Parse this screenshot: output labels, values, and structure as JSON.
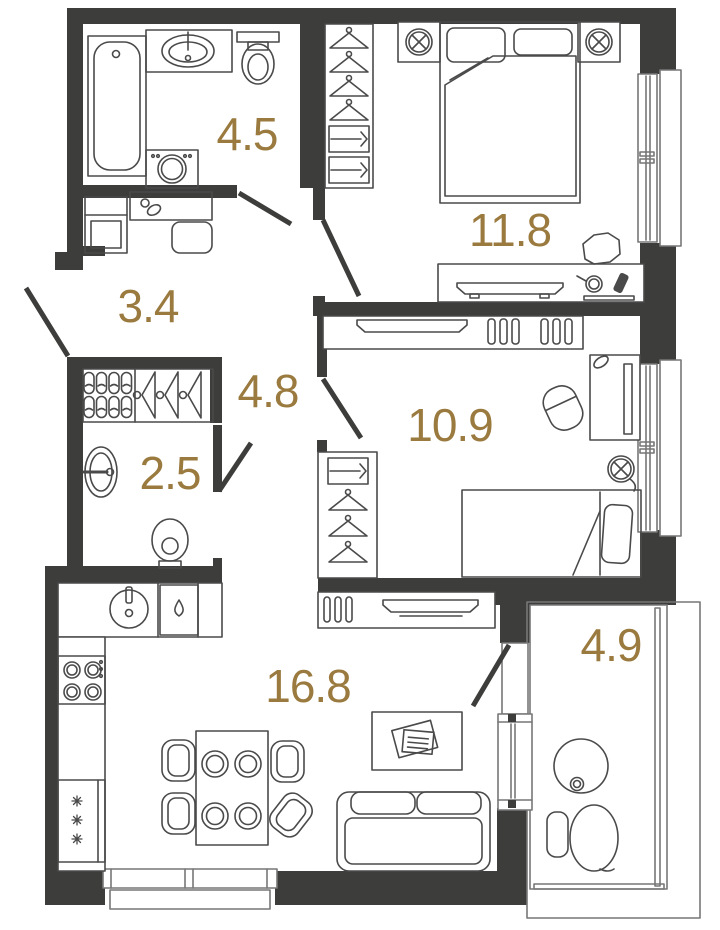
{
  "floor_plan": {
    "rooms": {
      "bathroom": {
        "label": "4.5",
        "furniture": [
          "bathtub",
          "sink",
          "toilet",
          "washing-machine"
        ]
      },
      "hallway": {
        "label": "3.4",
        "furniture": [
          "cabinet",
          "console",
          "stool"
        ]
      },
      "corridor": {
        "label": "4.8",
        "furniture": [
          "shoe-rack",
          "coat-hangers"
        ]
      },
      "wc": {
        "label": "2.5",
        "furniture": [
          "sink",
          "toilet"
        ]
      },
      "bedroom": {
        "label": "11.8",
        "furniture": [
          "wardrobe",
          "double-bed",
          "nightstands",
          "lamps",
          "dresser-tv",
          "chair"
        ]
      },
      "child_room": {
        "label": "10.9",
        "furniture": [
          "tv-stand",
          "desk",
          "chair",
          "lamp",
          "single-bed",
          "wardrobe"
        ]
      },
      "kitchen_living": {
        "label": "16.8",
        "furniture": [
          "kitchen-counter",
          "sink",
          "dishwasher",
          "stove",
          "fridge",
          "dining-table",
          "chairs",
          "sofa",
          "coffee-table",
          "tv-stand"
        ]
      },
      "balcony": {
        "label": "4.9",
        "furniture": [
          "round-table",
          "chair"
        ]
      }
    },
    "colors": {
      "wall": "#3d3d3b",
      "label": "#9a7a3e",
      "furniture_line": "#4a4a4a",
      "window_frame": "#777777"
    }
  }
}
